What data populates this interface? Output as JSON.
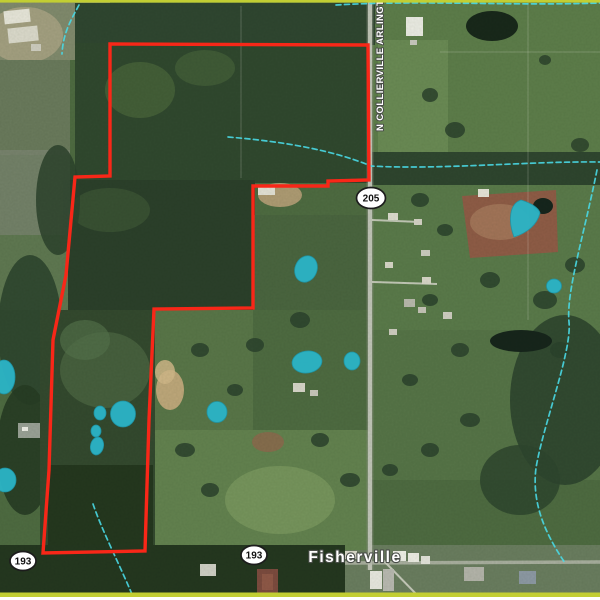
{
  "map": {
    "road_label": "N COLLIERVILLE ARLINGTON",
    "town_label": "Fisherville",
    "shields": [
      {
        "label": "205",
        "cx": 371,
        "cy": 198,
        "rx": 14.5,
        "ry": 10.5
      },
      {
        "label": "193",
        "cx": 254,
        "cy": 555,
        "rx": 13,
        "ry": 9.5
      },
      {
        "label": "193",
        "cx": 23,
        "cy": 561,
        "rx": 13,
        "ry": 9.5
      }
    ],
    "colors": {
      "parcel_outline": "#f82718",
      "pond_highlight": "#2bb3c5",
      "creek": "#49d8e4",
      "route_strip": "#c2ce33"
    },
    "parcel": {
      "path_d": "M110,44 L368,45 L369,180 L328,181 L328,186 L253,186 L253,308 L154,309 L149,420 L145,551 L43,553 L49,470 L53,340 L66,275 L75,177 L110,176 Z"
    },
    "creeks": [
      {
        "d": "M336,5 C420,0 510,6 600,3"
      },
      {
        "d": "M228,137 C278,141 330,149 371,166 C440,170 530,161 600,162"
      },
      {
        "d": "M79,5 C71,20 63,33 62,54"
      },
      {
        "d": "M93,504 C103,533 119,563 134,599"
      },
      {
        "d": "M597,170 C584,235 566,292 569,322 C572,352 543,425 536,468 C531,507 549,539 565,563"
      }
    ],
    "ponds": [
      {
        "cx": 554,
        "cy": 286,
        "rx": 7.5,
        "ry": 7,
        "rot": 0
      },
      {
        "cx": 306,
        "cy": 269,
        "rx": 11,
        "ry": 13.5,
        "rot": 22
      },
      {
        "cx": 307,
        "cy": 362,
        "rx": 15,
        "ry": 11,
        "rot": -8
      },
      {
        "cx": 352,
        "cy": 361,
        "rx": 8,
        "ry": 9,
        "rot": 0
      },
      {
        "cx": 123,
        "cy": 414,
        "rx": 12.5,
        "ry": 13,
        "rot": 0
      },
      {
        "cx": 100,
        "cy": 413,
        "rx": 6,
        "ry": 7,
        "rot": 0
      },
      {
        "cx": 96,
        "cy": 431,
        "rx": 5,
        "ry": 6,
        "rot": 0
      },
      {
        "cx": 97,
        "cy": 446,
        "rx": 6.5,
        "ry": 9,
        "rot": 12
      },
      {
        "cx": 217,
        "cy": 412,
        "rx": 10,
        "ry": 10.5,
        "rot": 0
      },
      {
        "cx": 4,
        "cy": 377,
        "rx": 11,
        "ry": 17,
        "rot": 0
      },
      {
        "cx": 5,
        "cy": 480,
        "rx": 11,
        "ry": 12,
        "rot": 0
      }
    ],
    "pond_paths": [
      {
        "d": "M514,237 C508,221 509,204 521,200 C531,203 539,208 540,213 C537,225 527,233 514,237 Z"
      }
    ]
  }
}
